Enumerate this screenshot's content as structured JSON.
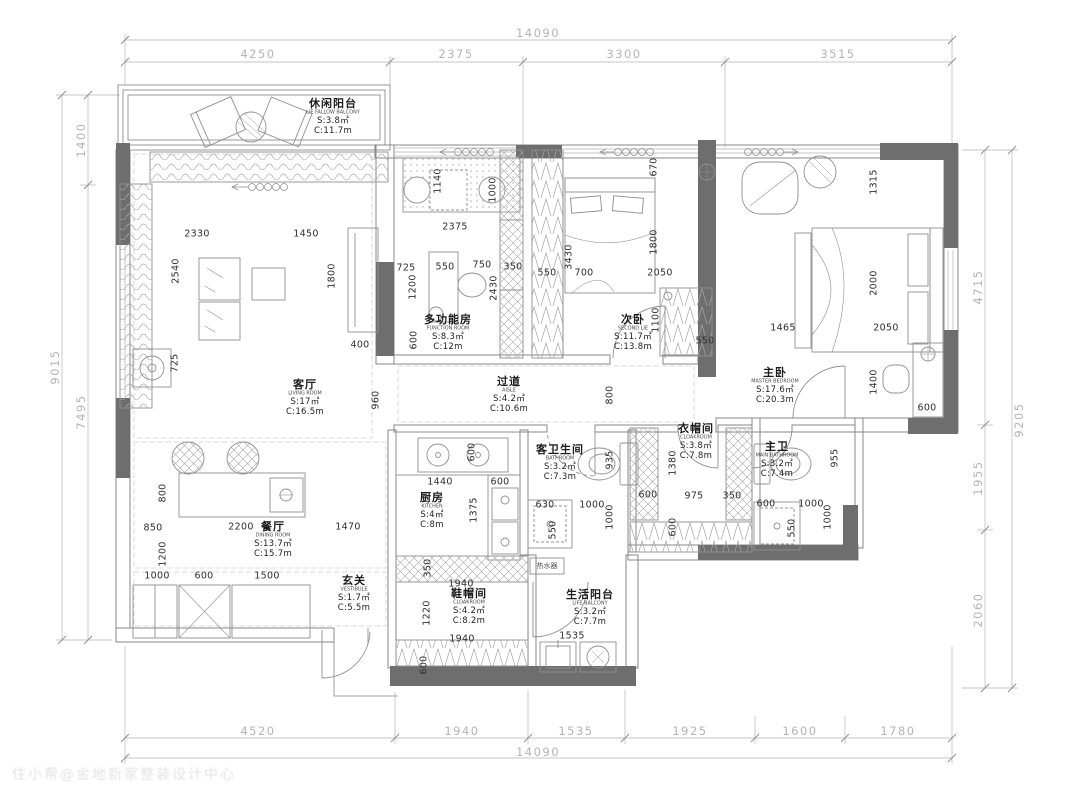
{
  "watermark": "住小帮@金地新家整装设计中心",
  "water_heater_label": "热水器",
  "outer_dims": {
    "top_total": "14090",
    "top": [
      "4250",
      "2375",
      "3300",
      "3515"
    ],
    "bottom": [
      "4520",
      "1940",
      "1535",
      "1925",
      "1600",
      "1780"
    ],
    "bottom_total": "14090",
    "left": [
      "1400",
      "7495"
    ],
    "left_total": "9015",
    "right": [
      "4715",
      "1955",
      "2060"
    ],
    "right_total": "9205"
  },
  "rooms": [
    {
      "cn": "休闲阳台",
      "en": "LIE FALLOW BALCONY",
      "s": "S:3.8㎡",
      "c": "C:11.7m"
    },
    {
      "cn": "客厅",
      "en": "LIVING ROOM",
      "s": "S:17㎡",
      "c": "C:16.5m"
    },
    {
      "cn": "多功能房",
      "en": "FUNCTION ROOM",
      "s": "S:8.3㎡",
      "c": "C:12m"
    },
    {
      "cn": "过道",
      "en": "AISLE",
      "s": "S:4.2㎡",
      "c": "C:10.6m"
    },
    {
      "cn": "次卧",
      "en": "SECOND LIE",
      "s": "S:11.7㎡",
      "c": "C:13.8m"
    },
    {
      "cn": "主卧",
      "en": "MASTER BEDROOM",
      "s": "S:17.6㎡",
      "c": "C:20.3m"
    },
    {
      "cn": "餐厅",
      "en": "DINING ROOM",
      "s": "S:13.7㎡",
      "c": "C:15.7m"
    },
    {
      "cn": "玄关",
      "en": "VESTIBULE",
      "s": "S:1.7㎡",
      "c": "C:5.5m"
    },
    {
      "cn": "厨房",
      "en": "KITCHEN",
      "s": "S:4㎡",
      "c": "C:8m"
    },
    {
      "cn": "客卫生间",
      "en": "BATHROOM",
      "s": "S:3.2㎡",
      "c": "C:7.3m"
    },
    {
      "cn": "衣帽间",
      "en": "CLOAKROOM",
      "s": "S:3.8㎡",
      "c": "C:7.8m"
    },
    {
      "cn": "主卫",
      "en": "MAIN BATHROOM",
      "s": "S:3.2㎡",
      "c": "C:7.4m"
    },
    {
      "cn": "鞋帽间",
      "en": "CLOAKROOM",
      "s": "S:4.2㎡",
      "c": "C:8.2m"
    },
    {
      "cn": "生活阳台",
      "en": "LIFE BALCONY",
      "s": "S:3.2㎡",
      "c": "C:7.7m"
    }
  ],
  "inner_dims": [
    "2330",
    "1450",
    "2540",
    "1800",
    "725",
    "400",
    "960",
    "725",
    "550",
    "750",
    "350",
    "1200",
    "2430",
    "600",
    "1140",
    "1000",
    "2375",
    "3430",
    "550",
    "700",
    "2050",
    "670",
    "1800",
    "1100",
    "550",
    "800",
    "1315",
    "2000",
    "1465",
    "2050",
    "1400",
    "600",
    "600",
    "1440",
    "600",
    "1375",
    "630",
    "1000",
    "550",
    "935",
    "1000",
    "600",
    "1380",
    "975",
    "350",
    "600",
    "600",
    "1000",
    "550",
    "1000",
    "955",
    "800",
    "850",
    "2200",
    "1470",
    "1200",
    "1000",
    "600",
    "1500",
    "350",
    "1940",
    "1220",
    "1940",
    "600",
    "1535"
  ]
}
